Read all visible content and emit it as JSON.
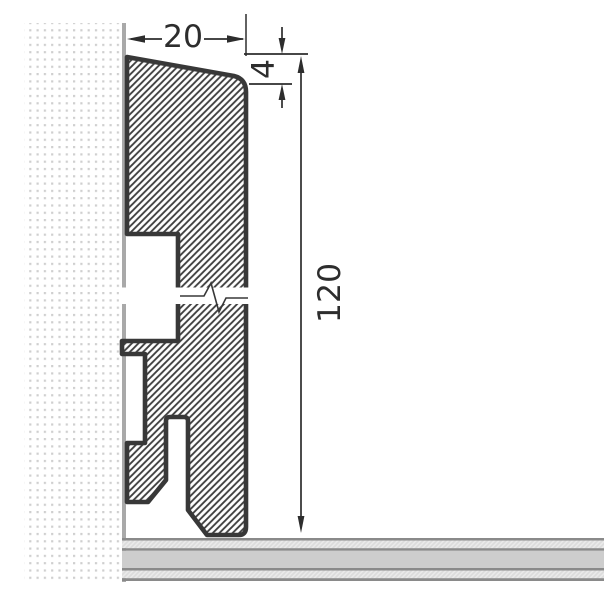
{
  "drawing": {
    "type": "technical-drawing",
    "subject": "skirting-board profile cross-section fixed to a wall above a floor, with break symbol in mid-height",
    "units_shown": "mm",
    "dimensions": {
      "width": {
        "label": "20",
        "orientation": "horizontal",
        "position": "top"
      },
      "bevel_height": {
        "label": "4",
        "orientation": "vertical-rotated",
        "position": "top-right"
      },
      "total_height": {
        "label": "120",
        "orientation": "vertical-rotated",
        "position": "right"
      }
    },
    "colors": {
      "background": "#ffffff",
      "outline": "#383838",
      "hatch_line": "#3f3f3f",
      "dimension_line": "#2d2d2d",
      "wall_dot": "#cfcfcf",
      "wall_face_line": "#a9a9a9",
      "floor_border": "#8a8a8a",
      "floor_solid": "#cdcdcd",
      "floor_hatch_bg": "#dcdcdc",
      "floor_hatch_line": "#ebebeb"
    }
  }
}
